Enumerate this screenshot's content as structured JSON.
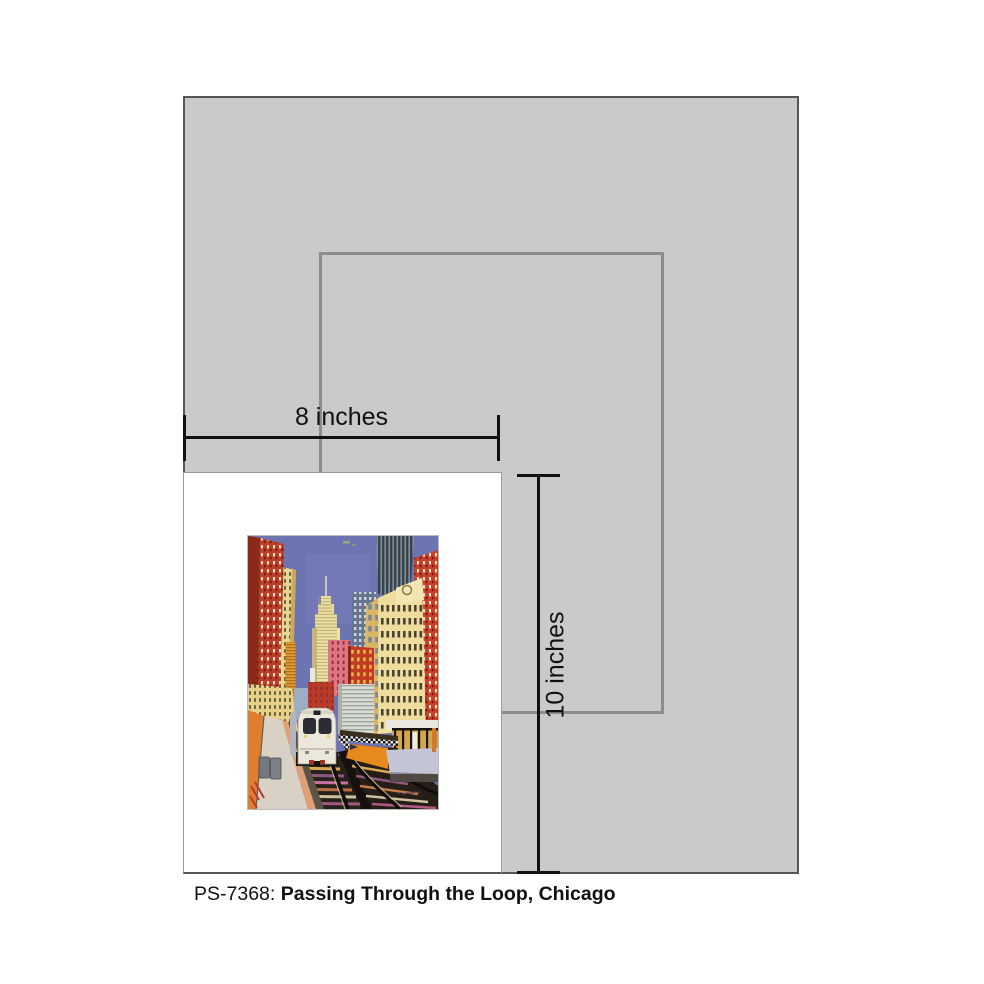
{
  "caption": {
    "code": "PS-7368:",
    "title": "Passing Through the Loop, Chicago"
  },
  "size_diagram": {
    "width_dimension_label": "8 inches",
    "height_dimension_label": "10 inches"
  },
  "artwork": {
    "subject": "elevated CTA train passing through the Chicago Loop between red and yellow skyscrapers"
  },
  "colors": {
    "frame-gray": "#c9cacb",
    "frame-border": "#565656",
    "paper-outline": "#8c8c8c",
    "print-white": "#ffffff",
    "print-border": "#9b9b9b",
    "dimension-black": "#111111",
    "text-black": "#111111"
  }
}
